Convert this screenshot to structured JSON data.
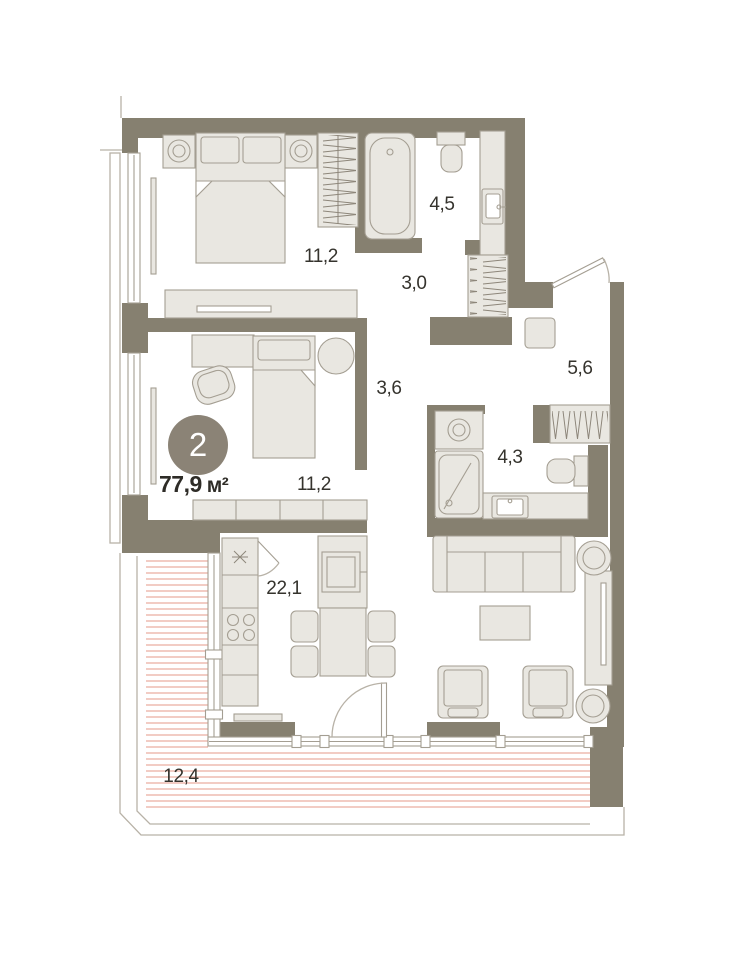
{
  "plan": {
    "type": "apartment-floor-plan",
    "badge": {
      "value": "2"
    },
    "total_area": {
      "value": "77,9",
      "unit": "м²"
    },
    "rooms": [
      {
        "name": "bedroom-1",
        "area": "11,2"
      },
      {
        "name": "bathroom",
        "area": "4,5"
      },
      {
        "name": "hallway",
        "area": "3,0"
      },
      {
        "name": "entry-hall",
        "area": "5,6"
      },
      {
        "name": "corridor",
        "area": "3,6"
      },
      {
        "name": "shower-room",
        "area": "4,3"
      },
      {
        "name": "bedroom-2",
        "area": "11,2"
      },
      {
        "name": "kitchen-living-room",
        "area": "22,1"
      },
      {
        "name": "terrace",
        "area": "12,4"
      }
    ],
    "colors": {
      "wall": "#868070",
      "furniture_fill": "#e9e7e1",
      "furniture_stroke": "#a49e92",
      "terrace_hatch": "#e4998a",
      "badge_bg": "#8b8376",
      "label_text": "#35332d"
    }
  }
}
